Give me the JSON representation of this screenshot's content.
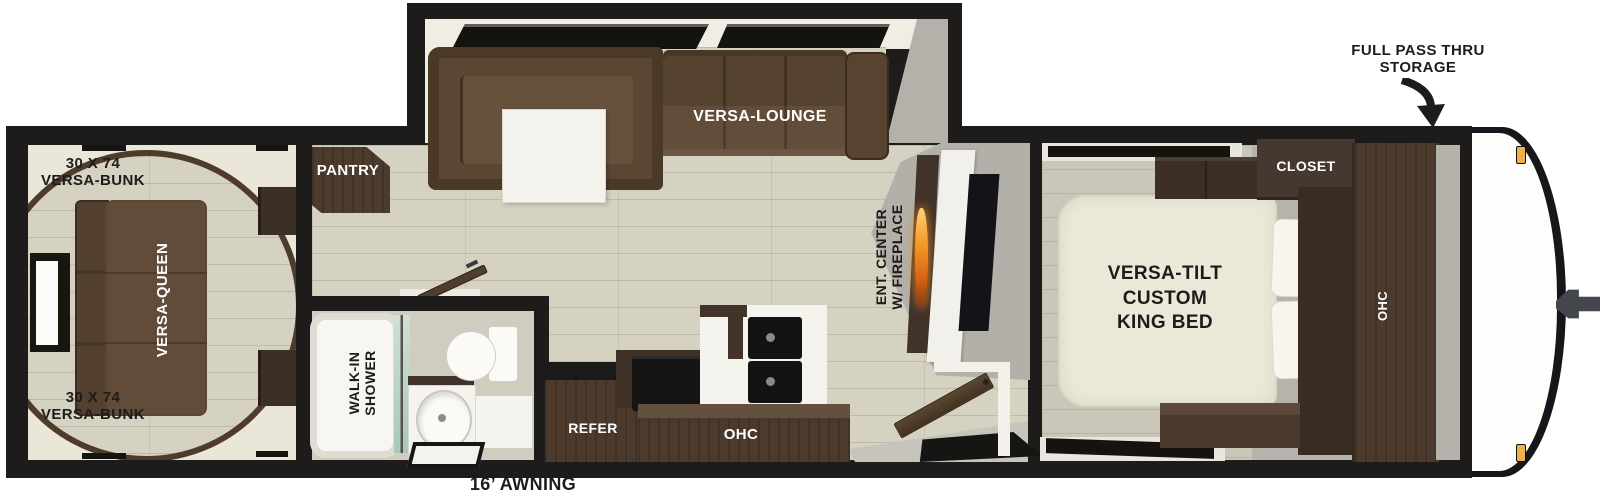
{
  "labels": {
    "panoramic_window": "PANORAMIC WINDOW",
    "full_pass_thru_line1": "FULL PASS THRU",
    "full_pass_thru_line2": "STORAGE",
    "bunk_top_line1": "30 X 74",
    "bunk_top_line2": "VERSA-BUNK",
    "bunk_bottom_line1": "30 X 74",
    "bunk_bottom_line2": "VERSA-BUNK",
    "versa_queen": "VERSA-QUEEN",
    "pantry": "PANTRY",
    "versa_lounge": "VERSA-LOUNGE",
    "ent_center_line1": "ENT. CENTER",
    "ent_center_line2": "W/ FIREPLACE",
    "walk_in_shower_line1": "WALK-IN",
    "walk_in_shower_line2": "SHOWER",
    "refer": "REFER",
    "kitchen_ohc": "OHC",
    "closet": "CLOSET",
    "king_bed_line1": "VERSA-TILT",
    "king_bed_line2": "CUSTOM",
    "king_bed_line3": "KING BED",
    "bedroom_ohc": "OHC",
    "awning": "16’ AWNING"
  },
  "colors": {
    "wall": "#1d1c1a",
    "floor_wood": "#d6d2c2",
    "floor_gray": "#b5b3ac",
    "cabinet_wood": "#4c3b2d",
    "sofa_brown": "#5b4634",
    "mattress_cream": "#ebe8d7",
    "flame_orange": "#e8821e",
    "marker_amber": "#edb04b",
    "shower_glass": "#bcd6c6"
  }
}
